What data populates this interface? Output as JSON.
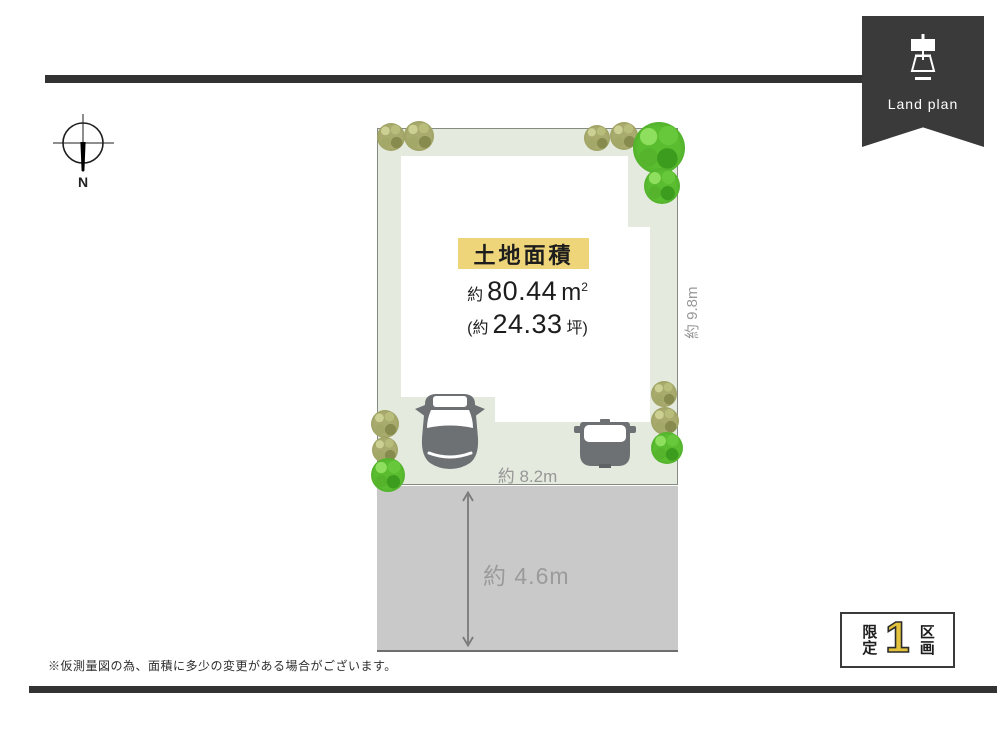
{
  "ribbon": {
    "label": "Land plan",
    "icon": "surveyor-lamp-icon",
    "bg_color": "#3a3a3a"
  },
  "compass": {
    "north_label": "N"
  },
  "lot": {
    "area_title": "土地面積",
    "area_sqm": {
      "prefix": "約",
      "value": "80.44",
      "unit": "m",
      "unit_sup": "2"
    },
    "area_tsubo": {
      "prefix": "(約",
      "value": "24.33",
      "suffix": "坪)"
    },
    "dimensions": {
      "right_side": "約 9.8m",
      "frontage": "約 8.2m",
      "road_width": "約 4.6m"
    },
    "colors": {
      "lot_green": "#e5eadf",
      "road_gray": "#c9c9c9",
      "highlight_yellow": "#eed579",
      "tree_green": "#5abd30",
      "bush_olive": "#a8ab6d",
      "car_gray": "#6e7174"
    }
  },
  "badge": {
    "left_label": "限定",
    "count": "1",
    "right_label": "区画",
    "count_color": "#e3c23c"
  },
  "footnote": "※仮測量図の為、面積に多少の変更がある場合がございます。"
}
